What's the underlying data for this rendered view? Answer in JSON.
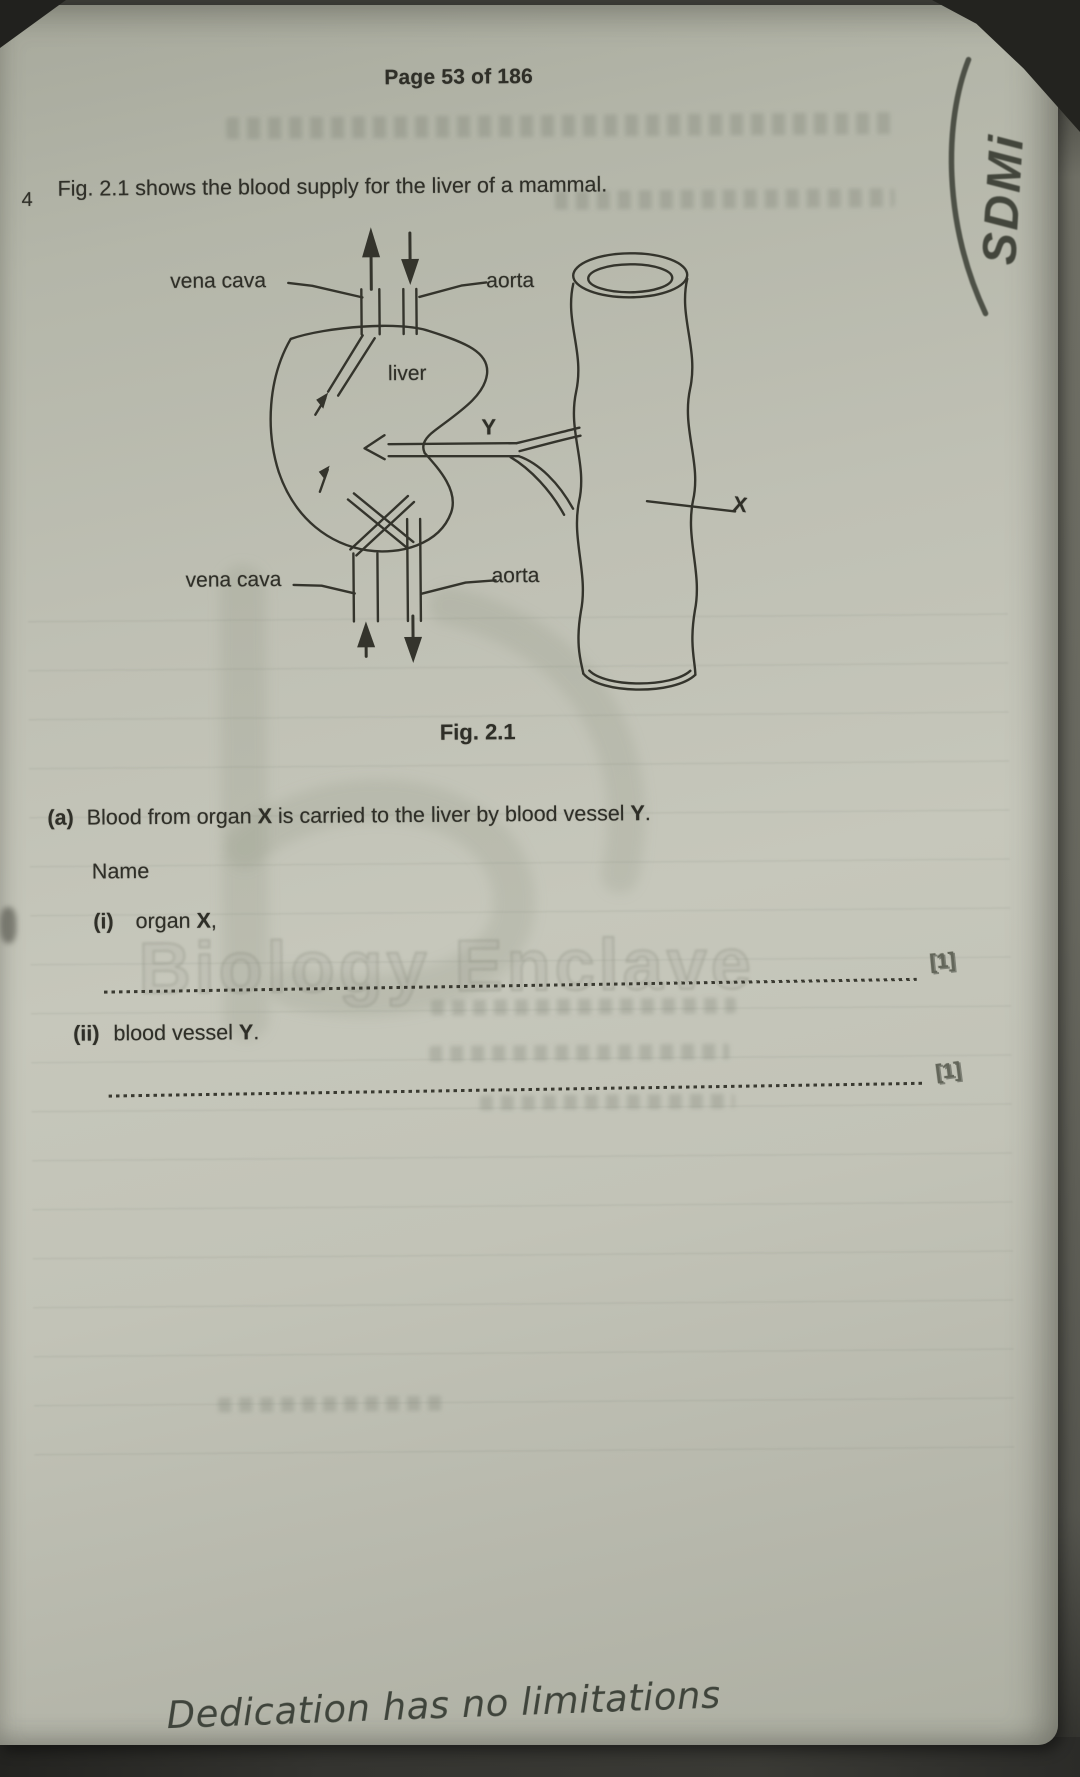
{
  "header": {
    "page_indicator": "Page 53 of 186"
  },
  "question": {
    "number": "4",
    "intro": "Fig. 2.1 shows the blood supply for the liver of a mammal."
  },
  "figure": {
    "caption": "Fig. 2.1",
    "labels": {
      "vena_cava_top": "vena cava",
      "aorta_top": "aorta",
      "liver": "liver",
      "vessel_y": "Y",
      "organ_x": "X",
      "vena_cava_bottom": "vena cava",
      "aorta_bottom": "aorta"
    }
  },
  "part_a": {
    "label": "(a)",
    "sentence_pre": "Blood from organ ",
    "sentence_x": "X",
    "sentence_mid": " is carried to the liver by blood vessel ",
    "sentence_y": "Y",
    "sentence_end": ".",
    "name_heading": "Name",
    "item_i_label": "(i)",
    "item_i_pre": "organ ",
    "item_i_bold": "X",
    "item_i_suffix": ",",
    "item_i_marks": "[1]",
    "item_ii_label": "(ii)",
    "item_ii_pre": "blood vessel ",
    "item_ii_bold": "Y",
    "item_ii_suffix": ".",
    "item_ii_marks": "[1]"
  },
  "watermark": {
    "text": "Biology Enclave"
  },
  "handwriting": {
    "corner_signature": "SDMi",
    "bottom_quote": "Dedication has no limitations"
  },
  "colors": {
    "paper": "#c3c4b8",
    "ink": "#2f2f28",
    "pencil_ink": "#43463c",
    "backdrop": "#3c3c37"
  }
}
